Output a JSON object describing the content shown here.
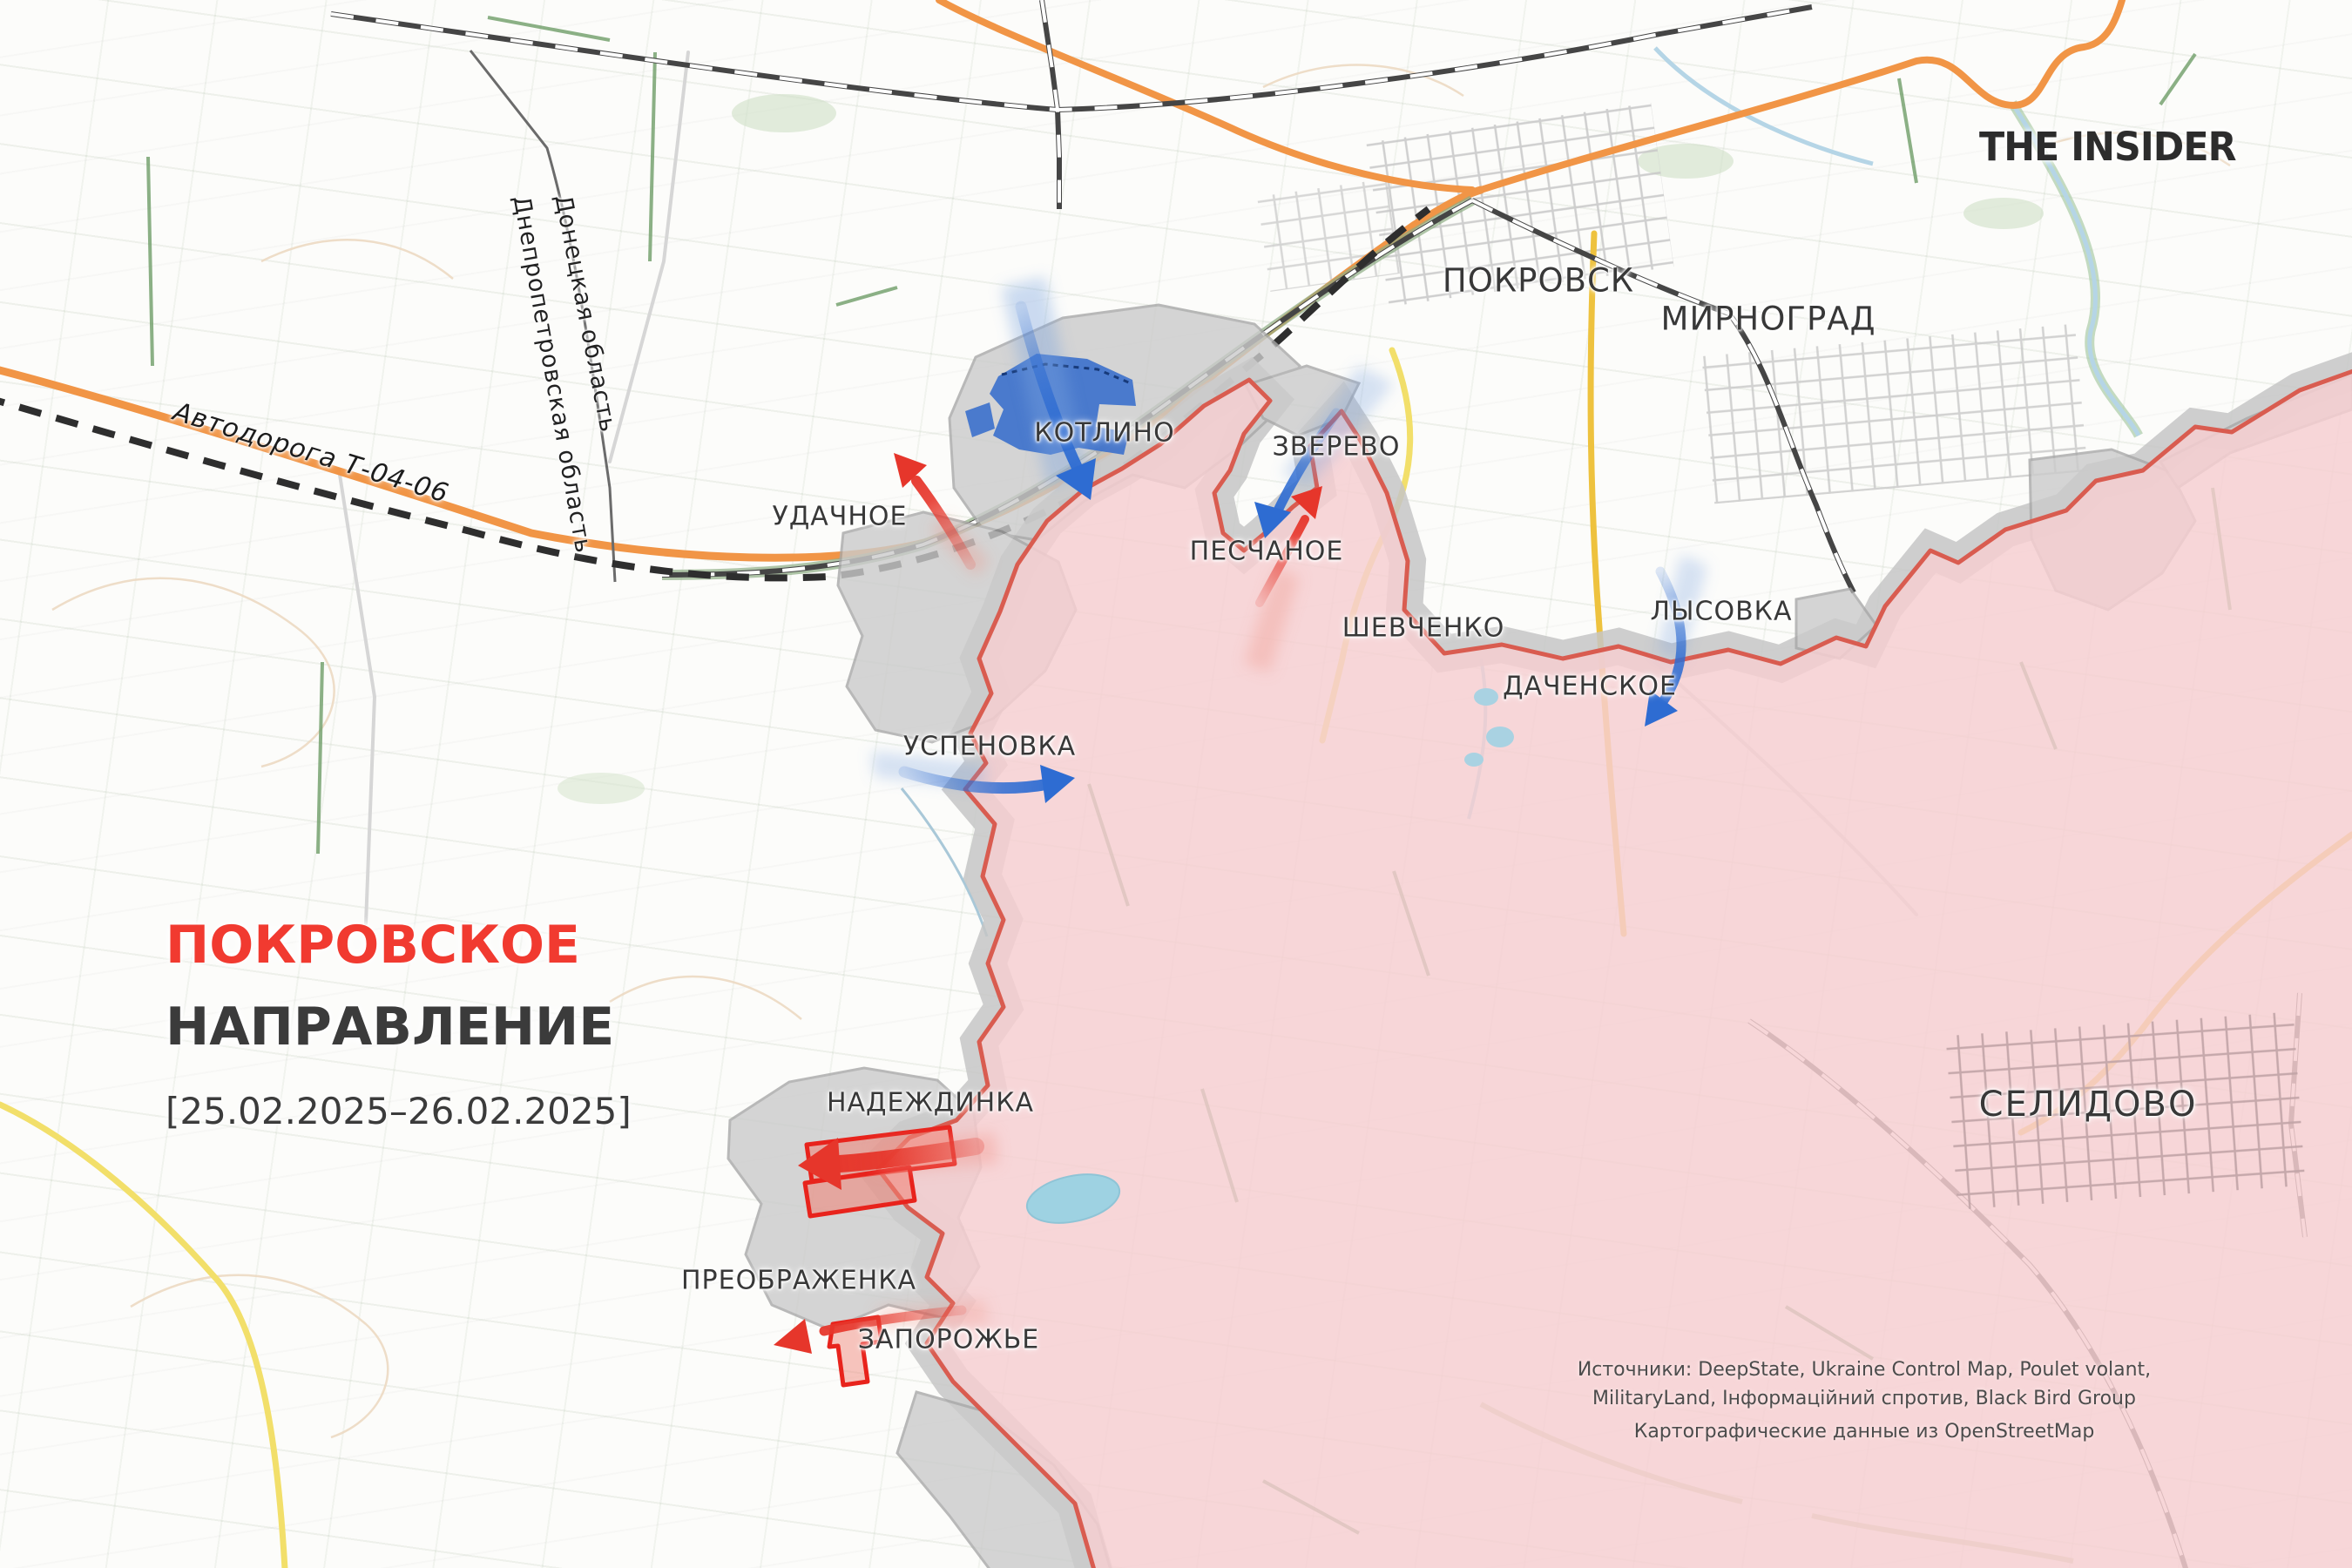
{
  "branding": {
    "logo": "THE INSIDER"
  },
  "title": {
    "line1": "ПОКРОВСКОЕ",
    "line2": "НАПРАВЛЕНИЕ",
    "date_range": "[25.02.2025–26.02.2025]"
  },
  "map": {
    "cities": [
      {
        "name": "ПОКРОВСК"
      },
      {
        "name": "МИРНОГРАД"
      },
      {
        "name": "КОТЛИНО"
      },
      {
        "name": "ЗВЕРЕВО"
      },
      {
        "name": "УДАЧНОЕ"
      },
      {
        "name": "ПЕСЧАНОЕ"
      },
      {
        "name": "ШЕВЧЕНКО"
      },
      {
        "name": "ЛЫСОВКА"
      },
      {
        "name": "ДАЧЕНСКОЕ"
      },
      {
        "name": "УСПЕНОВКА"
      },
      {
        "name": "СЕЛИДОВО"
      },
      {
        "name": "НАДЕЖДИНКА"
      },
      {
        "name": "ПРЕОБРАЖЕНКА"
      },
      {
        "name": "ЗАПОРОЖЬЕ"
      }
    ],
    "regions": {
      "donetsk": "Донецкая область",
      "dnipro": "Днепропетровская область"
    },
    "road_label": "Автодорога Т-04-06",
    "colors": {
      "occupied_fill": "#f6ced1",
      "front_line": "#d95c50",
      "contested_gray": "#c8c8c8",
      "russian_advance_red": "#e6362b",
      "ukrainian_advance_blue": "#2e6cd2",
      "accent_title_red": "#f13a30",
      "road_orange": "#f19546",
      "road_yellow": "#f2df6a"
    }
  },
  "sources": {
    "line1": "Источники: DeepState, Ukraine Control Map, Poulet volant,",
    "line2": "MilitaryLand, Інформаційний спротив, Black Bird Group",
    "line3": "Картографические данные из OpenStreetMap"
  }
}
